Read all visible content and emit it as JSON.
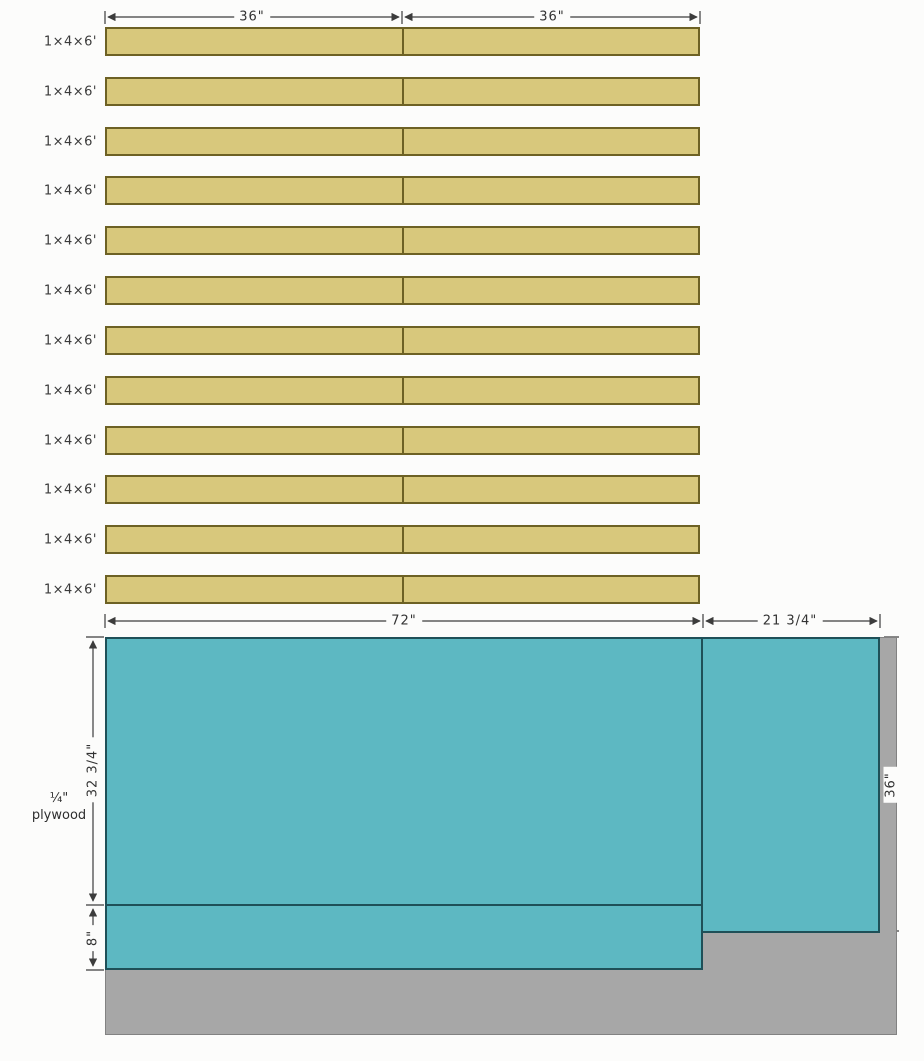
{
  "boards_section": {
    "board_label": "1×4×6'",
    "board_count": 12,
    "dim_segment_left": "36\"",
    "dim_segment_right": "36\""
  },
  "plywood_section": {
    "material_label_line1": "¼\"",
    "material_label_line2": "plywood",
    "dim_top_left": "72\"",
    "dim_top_right": "21 3/4\"",
    "dim_left_upper": "32 3/4\"",
    "dim_left_lower": "8\"",
    "dim_right": "36\""
  },
  "colors": {
    "background": "#fcfcfb",
    "board_fill": "#d8c87c",
    "board_border": "#6d6124",
    "plywood_piece_fill": "#5db8c2",
    "plywood_piece_border": "#1f5058",
    "sheet_fill": "#a7a7a7",
    "sheet_border": "#828282",
    "dimension_line": "#3c3c3c"
  }
}
